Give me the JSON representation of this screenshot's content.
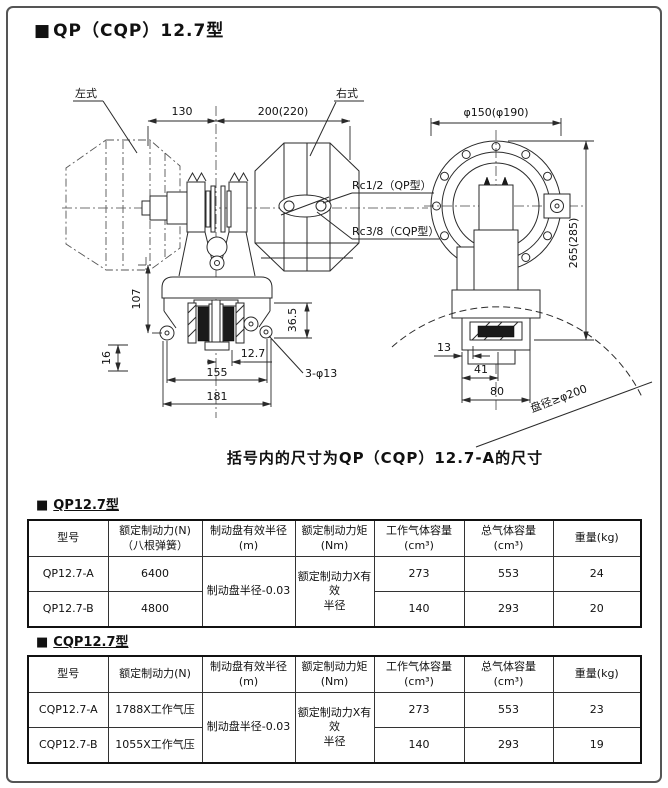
{
  "title": {
    "marker": "■",
    "text": "QP（CQP）12.7型"
  },
  "caption": "括号内的尺寸为QP（CQP）12.7-A的尺寸",
  "drawing": {
    "left_label": "左式",
    "right_label": "右式",
    "rc_qp": "Rc1/2（QP型）",
    "rc_cqp": "Rc3/8（CQP型）",
    "disc_note": "盘径≥φ200",
    "dim_130": "130",
    "dim_200": "200(220)",
    "dim_phi150": "φ150(φ190)",
    "dim_265": "265(285)",
    "dim_107": "107",
    "dim_16": "16",
    "dim_36_5": "36.5",
    "dim_12_7": "12.7",
    "dim_155": "155",
    "dim_181": "181",
    "dim_3phi13": "3-φ13",
    "dim_13": "13",
    "dim_41": "41",
    "dim_80": "80"
  },
  "table_qp": {
    "marker": "■",
    "section_title": "QP12.7型",
    "headers": [
      "型号",
      "额定制动力(N)\n（八根弹簧）",
      "制动盘有效半径\n(m)",
      "额定制动力矩\n(Nm)",
      "工作气体容量\n(cm³)",
      "总气体容量\n(cm³)",
      "重量(kg)"
    ],
    "radius_note": "制动盘半径-0.03",
    "torque_note": "额定制动力X有效\n半径",
    "rows": [
      {
        "model": "QP12.7-A",
        "force": "6400",
        "work_volume": "273",
        "total_volume": "553",
        "weight": "24"
      },
      {
        "model": "QP12.7-B",
        "force": "4800",
        "work_volume": "140",
        "total_volume": "293",
        "weight": "20"
      }
    ]
  },
  "table_cqp": {
    "marker": "■",
    "section_title": "CQP12.7型",
    "headers": [
      "型号",
      "额定制动力(N)",
      "制动盘有效半径\n(m)",
      "额定制动力矩\n(Nm)",
      "工作气体容量\n(cm³)",
      "总气体容量\n(cm³)",
      "重量(kg)"
    ],
    "radius_note": "制动盘半径-0.03",
    "torque_note": "额定制动力X有效\n半径",
    "rows": [
      {
        "model": "CQP12.7-A",
        "force": "1788X工作气压",
        "work_volume": "273",
        "total_volume": "553",
        "weight": "23"
      },
      {
        "model": "CQP12.7-B",
        "force": "1055X工作气压",
        "work_volume": "140",
        "total_volume": "293",
        "weight": "19"
      }
    ]
  }
}
